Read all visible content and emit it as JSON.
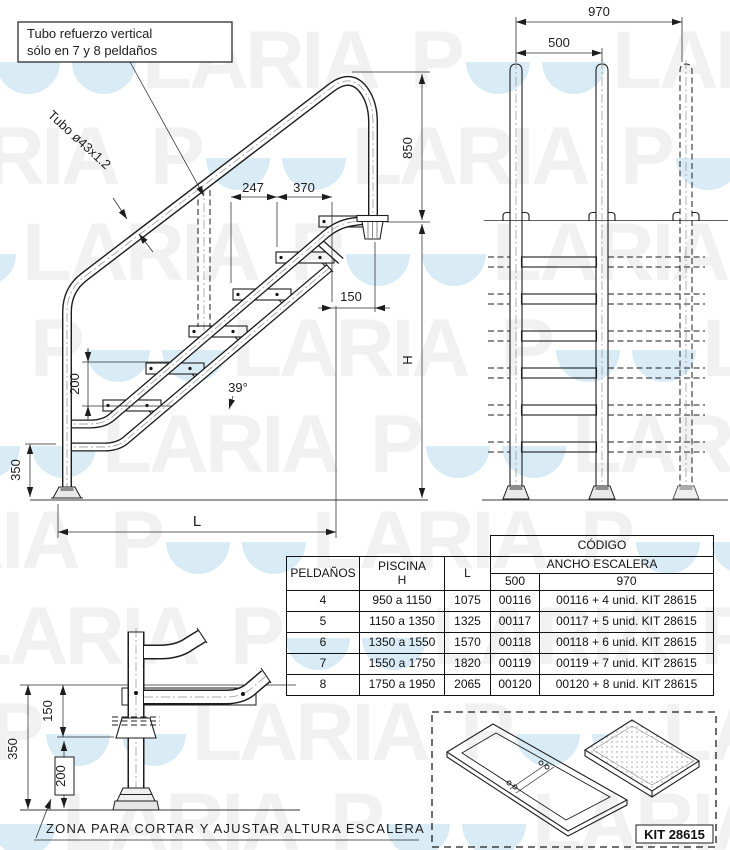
{
  "note_box": {
    "line1": "Tubo refuerzo vertical",
    "line2": "sólo en 7 y 8 peldaños"
  },
  "side_view": {
    "tube_label": "Tubo ø43x1.2",
    "dim_247": "247",
    "dim_370": "370",
    "dim_850": "850",
    "dim_150": "150",
    "dim_200": "200",
    "dim_350": "350",
    "angle": "39°",
    "height_label": "H",
    "length_label": "L"
  },
  "front_view": {
    "dim_970": "970",
    "dim_500": "500"
  },
  "detail_view": {
    "dim_150": "150",
    "dim_350": "350",
    "dim_200": "200",
    "note": "ZONA PARA CORTAR Y AJUSTAR ALTURA ESCALERA"
  },
  "kit_box": {
    "label": "KIT 28615"
  },
  "table": {
    "headers": {
      "peldanos": "PELDAÑOS",
      "piscina": "PISCINA",
      "piscina_sub": "H",
      "length": "L",
      "codigo": "CÓDIGO",
      "ancho": "ANCHO ESCALERA",
      "w500": "500",
      "w970": "970"
    },
    "rows": [
      [
        "4",
        "950 a 1150",
        "1075",
        "00116",
        "00116 + 4 unid. KIT 28615"
      ],
      [
        "5",
        "1150 a 1350",
        "1325",
        "00117",
        "00117 + 5 unid. KIT 28615"
      ],
      [
        "6",
        "1350 a 1550",
        "1570",
        "00118",
        "00118 + 6 unid. KIT 28615"
      ],
      [
        "7",
        "1550 a 1750",
        "1820",
        "00119",
        "00119 + 7 unid. KIT 28615"
      ],
      [
        "8",
        "1750 a 1950",
        "2065",
        "00120",
        "00120 + 8 unid. KIT 28615"
      ]
    ]
  },
  "watermark": {
    "brand": "POOLARIA",
    "text_color": "#f1f1f1",
    "water_color": "#d9ecf6",
    "rows": [
      88,
      184,
      280,
      376,
      472,
      568,
      664,
      760,
      850
    ],
    "offsets": [
      -60,
      -320,
      -180,
      -440,
      -100,
      -360,
      -240,
      -480,
      -140
    ],
    "unit_width": 470,
    "units": 3
  },
  "colors": {
    "line": "#1d1d1d",
    "dim_text": "#1d1d1d"
  }
}
